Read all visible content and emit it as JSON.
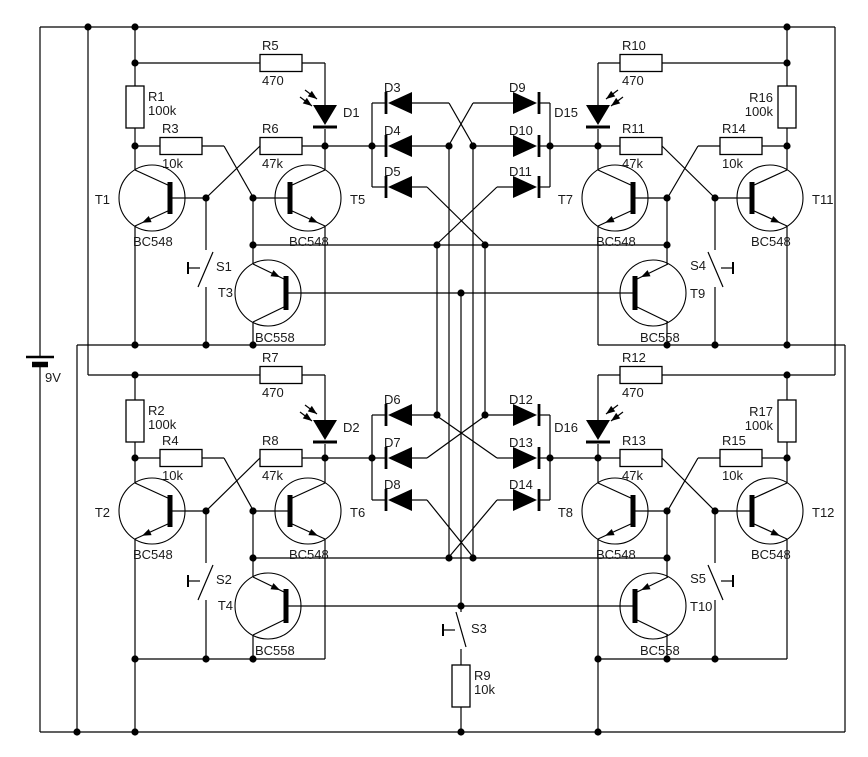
{
  "schematic": {
    "title": "quad-flip-flop-led-circuit",
    "colors": {
      "wire": "#000000",
      "text": "#1a1a1a",
      "background": "#ffffff"
    },
    "battery": {
      "id": "BAT",
      "label": "9V"
    },
    "resistors": [
      {
        "id": "R1",
        "value": "100k"
      },
      {
        "id": "R2",
        "value": "100k"
      },
      {
        "id": "R3",
        "value": "10k"
      },
      {
        "id": "R4",
        "value": "10k"
      },
      {
        "id": "R5",
        "value": "470"
      },
      {
        "id": "R6",
        "value": "47k"
      },
      {
        "id": "R7",
        "value": "470"
      },
      {
        "id": "R8",
        "value": "47k"
      },
      {
        "id": "R9",
        "value": "10k"
      },
      {
        "id": "R10",
        "value": "470"
      },
      {
        "id": "R11",
        "value": "47k"
      },
      {
        "id": "R12",
        "value": "470"
      },
      {
        "id": "R13",
        "value": "47k"
      },
      {
        "id": "R14",
        "value": "10k"
      },
      {
        "id": "R15",
        "value": "10k"
      },
      {
        "id": "R16",
        "value": "100k"
      },
      {
        "id": "R17",
        "value": "100k"
      }
    ],
    "transistors": [
      {
        "id": "T1",
        "part": "BC548"
      },
      {
        "id": "T2",
        "part": "BC548"
      },
      {
        "id": "T3",
        "part": "BC558"
      },
      {
        "id": "T4",
        "part": "BC558"
      },
      {
        "id": "T5",
        "part": "BC548"
      },
      {
        "id": "T6",
        "part": "BC548"
      },
      {
        "id": "T7",
        "part": "BC548"
      },
      {
        "id": "T8",
        "part": "BC548"
      },
      {
        "id": "T9",
        "part": "BC558"
      },
      {
        "id": "T10",
        "part": "BC558"
      },
      {
        "id": "T11",
        "part": "BC548"
      },
      {
        "id": "T12",
        "part": "BC548"
      }
    ],
    "diodes": [
      {
        "id": "D3"
      },
      {
        "id": "D4"
      },
      {
        "id": "D5"
      },
      {
        "id": "D6"
      },
      {
        "id": "D7"
      },
      {
        "id": "D8"
      },
      {
        "id": "D9"
      },
      {
        "id": "D10"
      },
      {
        "id": "D11"
      },
      {
        "id": "D12"
      },
      {
        "id": "D13"
      },
      {
        "id": "D14"
      }
    ],
    "leds": [
      {
        "id": "D1"
      },
      {
        "id": "D2"
      },
      {
        "id": "D15"
      },
      {
        "id": "D16"
      }
    ],
    "switches": [
      {
        "id": "S1"
      },
      {
        "id": "S2"
      },
      {
        "id": "S3"
      },
      {
        "id": "S4"
      },
      {
        "id": "S5"
      }
    ]
  }
}
